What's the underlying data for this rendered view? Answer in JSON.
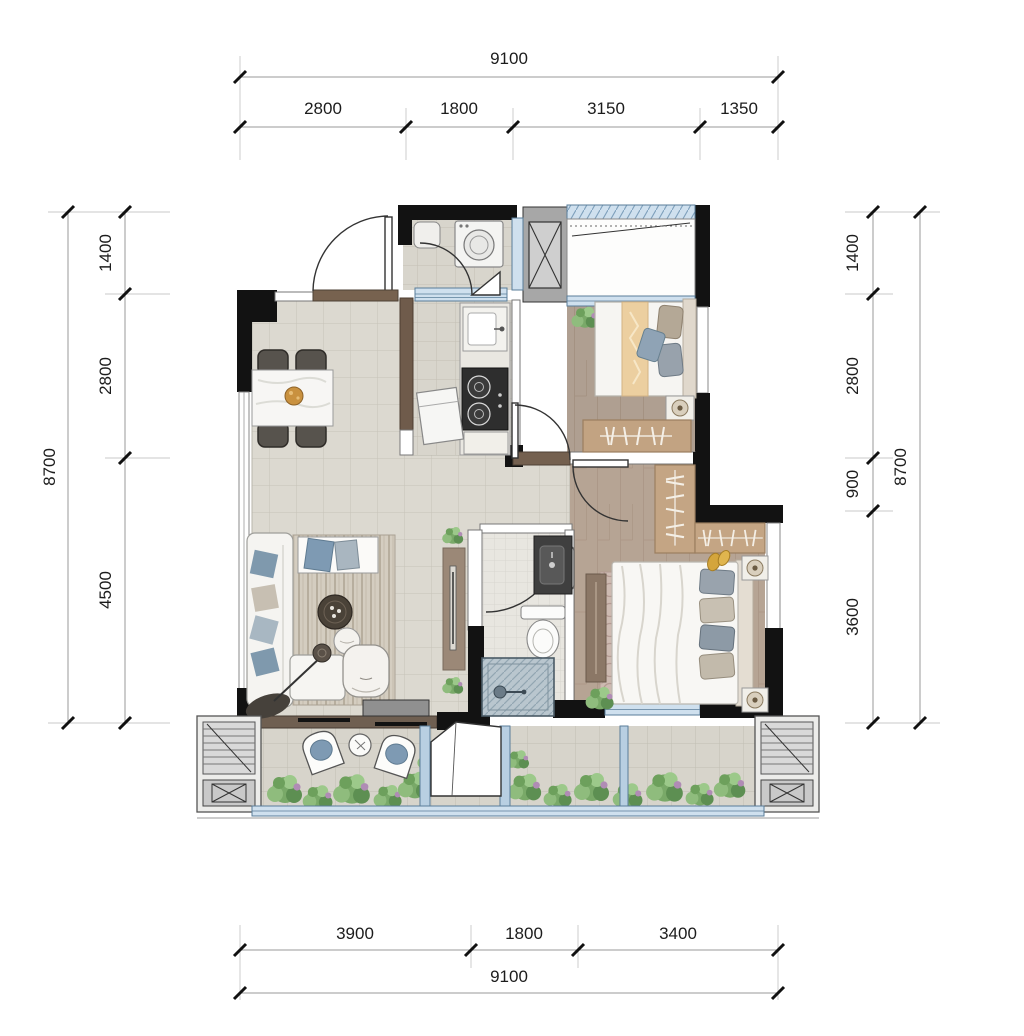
{
  "page": {
    "type": "architectural-floor-plan",
    "units": "mm"
  },
  "dims": {
    "top": {
      "total": "9100",
      "segments": [
        "2800",
        "1800",
        "3150",
        "1350"
      ]
    },
    "bottom": {
      "total": "9100",
      "segments": [
        "3900",
        "1800",
        "3400"
      ]
    },
    "left": {
      "total": "8700",
      "segments": [
        "1400",
        "2800",
        "4500"
      ]
    },
    "right": {
      "total": "8700",
      "segments": [
        "1400",
        "2800",
        "900",
        "3600"
      ]
    }
  },
  "colors": {
    "wall": "#121212",
    "window_glass": "#cfe0ee",
    "window_frame": "#5a7d99",
    "tile_floor": "#dcd9d0",
    "wood_floor": "#b2a090",
    "threshold_marble": "#6f5c4b",
    "greenery": "#79a968",
    "counter": "#efede7",
    "stove": "#2e2e2e",
    "shower": "#b9c6ce"
  }
}
